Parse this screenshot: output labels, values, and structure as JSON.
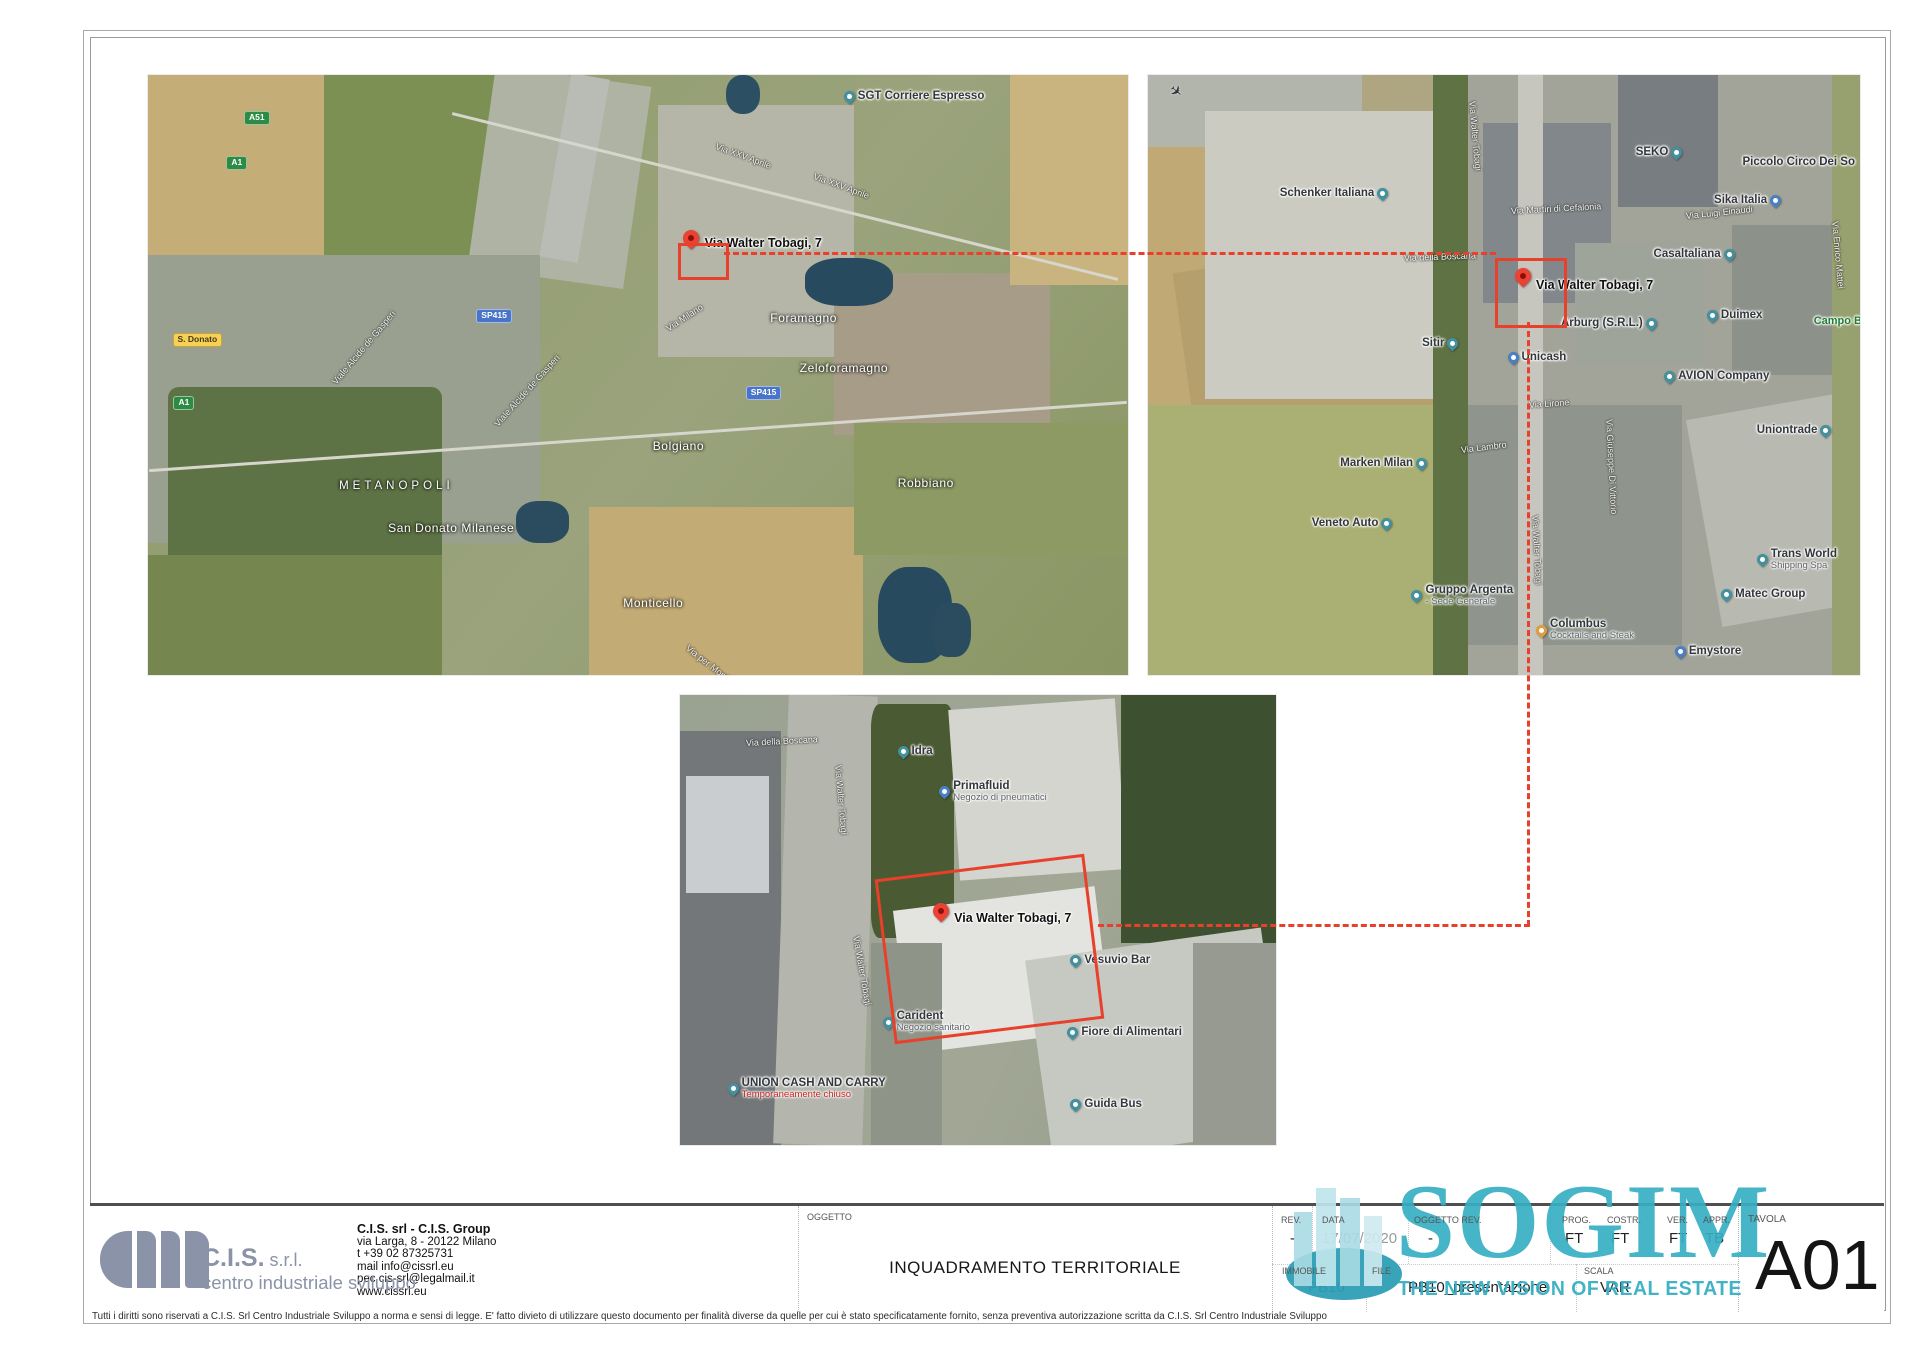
{
  "title_block": {
    "company": {
      "logo_name": "C.I.S.",
      "logo_suffix": " s.r.l.",
      "logo_sub": "centro industriale sviluppo",
      "name": "C.I.S. srl - C.I.S. Group",
      "address": "via Larga, 8 - 20122 Milano",
      "phone": "t +39 02 87325731",
      "mail": "mail   info@cissrl.eu",
      "pec": "pec   cis-srl@legalmail.it",
      "web": "www.cissrl.eu"
    },
    "oggetto": {
      "label": "OGGETTO",
      "value": "INQUADRAMENTO TERRITORIALE"
    },
    "fields": {
      "rev": {
        "label": "REV.",
        "value": "-"
      },
      "data": {
        "label": "DATA",
        "value": "17/07/2020"
      },
      "oggetto_rev": {
        "label": "OGGETTO REV.",
        "value": "-"
      },
      "prog": {
        "label": "PROG.",
        "value": "FT"
      },
      "costr": {
        "label": "COSTR.",
        "value": "FT"
      },
      "ver": {
        "label": "VER.",
        "value": "FT"
      },
      "appr": {
        "label": "APPR.",
        "value": "TB"
      },
      "immobile": {
        "label": "IMMOBILE",
        "value": "PB10"
      },
      "file": {
        "label": "FILE",
        "value": "PB10_presentazione"
      },
      "scala": {
        "label": "SCALA",
        "value": "VAR"
      },
      "tavola": {
        "label": "TAVOLA",
        "value": "A01"
      }
    },
    "sogim": {
      "name": "SOGIM",
      "tagline": "THE NEW VISION OF REAL ESTATE",
      "color": "#36afc3"
    }
  },
  "footer": {
    "text": "Tutti i diritti sono riservati a C.I.S. Srl Centro Industriale Sviluppo a norma e sensi di legge. E' fatto divieto di utilizzare questo documento per finalità diverse da quelle per cui è stato specificatamente fornito, senza preventiva autorizzazione scritta da C.I.S. Srl Centro Industriale Sviluppo",
    "site_annotation_color": "#e8402a"
  },
  "maps": {
    "map1": {
      "name": "wide-area satellite view",
      "labels": [
        {
          "t": "SGT Corriere Espresso",
          "x": 71,
          "y": 2.5,
          "k": "poi",
          "pin": "teal",
          "side": "l"
        },
        {
          "t": "Via XXV Aprile",
          "x": 58,
          "y": 11,
          "k": "road",
          "r": 20
        },
        {
          "t": "Via XXV Aprile",
          "x": 68,
          "y": 16,
          "k": "road",
          "r": 20
        },
        {
          "k": "marker",
          "x": 54.6,
          "y": 25.8
        },
        {
          "t": "Via Walter Tobagi, 7",
          "x": 56.8,
          "y": 26.8,
          "k": "addr"
        },
        {
          "t": "Foramagno",
          "x": 63.5,
          "y": 39.5,
          "k": "place"
        },
        {
          "t": "Zeloforamagno",
          "x": 66.5,
          "y": 47.8,
          "k": "place"
        },
        {
          "t": "Via Milano",
          "x": 53,
          "y": 41.5,
          "k": "road",
          "r": -33
        },
        {
          "t": "SP415",
          "x": 61,
          "y": 51.8,
          "k": "badge-blue"
        },
        {
          "t": "SP415",
          "x": 33.5,
          "y": 39,
          "k": "badge-blue"
        },
        {
          "t": "METANOPOLI",
          "x": 19.5,
          "y": 67.5,
          "k": "place-sp"
        },
        {
          "t": "S. Donato",
          "x": 2.5,
          "y": 43,
          "k": "badge-yellow"
        },
        {
          "t": "A1",
          "x": 2.6,
          "y": 53.5,
          "k": "badge-green"
        },
        {
          "t": "A51",
          "x": 9.8,
          "y": 6,
          "k": "badge-green"
        },
        {
          "t": "A1",
          "x": 8,
          "y": 13.5,
          "k": "badge-green"
        },
        {
          "t": "Viale Alcide de Gasperi",
          "x": 19,
          "y": 50.5,
          "k": "road",
          "r": -50
        },
        {
          "t": "Viale Alcide de Gasperi",
          "x": 35.5,
          "y": 57.5,
          "k": "road",
          "r": -48
        },
        {
          "t": "Bolgiano",
          "x": 51.5,
          "y": 60.8,
          "k": "place"
        },
        {
          "t": "San Donato Milanese",
          "x": 24.5,
          "y": 74.5,
          "k": "place"
        },
        {
          "t": "Robbiano",
          "x": 76.5,
          "y": 67,
          "k": "place"
        },
        {
          "t": "Monticello",
          "x": 48.5,
          "y": 87,
          "k": "place"
        },
        {
          "t": "Via per Monticello",
          "x": 55,
          "y": 94.5,
          "k": "road",
          "r": 38
        }
      ]
    },
    "map2": {
      "name": "neighbourhood satellite view",
      "labels": [
        {
          "k": "plane",
          "x": 3,
          "y": 1.5
        },
        {
          "t": "Schenker Italiana",
          "x": 18.5,
          "y": 18.6,
          "k": "poi",
          "pin": "teal",
          "side": "r"
        },
        {
          "t": "Via Walter Tobagi",
          "x": 45.5,
          "y": 3.5,
          "k": "road",
          "r": 85
        },
        {
          "t": "SEKO",
          "x": 68.5,
          "y": 11.8,
          "k": "poi",
          "pin": "teal",
          "side": "r"
        },
        {
          "t": "Piccolo Circo Dei So",
          "x": 83.5,
          "y": 13.5,
          "k": "poi"
        },
        {
          "t": "Sika Italia",
          "x": 79.5,
          "y": 19.8,
          "k": "poi",
          "pin": "blue",
          "side": "r"
        },
        {
          "t": "Via Luigi Einaudi",
          "x": 75.5,
          "y": 22.6,
          "k": "road",
          "r": -6
        },
        {
          "t": "Via Martiri di Cefalonia",
          "x": 51,
          "y": 21.8,
          "k": "road",
          "r": -3
        },
        {
          "t": "Casaltaliana",
          "x": 71,
          "y": 28.8,
          "k": "poi",
          "pin": "teal",
          "side": "r"
        },
        {
          "t": "Via della Boscana",
          "x": 36,
          "y": 29.6,
          "k": "road",
          "r": -2
        },
        {
          "k": "marker",
          "x": 51.5,
          "y": 32.2
        },
        {
          "t": "Via Walter Tobagi, 7",
          "x": 54.5,
          "y": 33.8,
          "k": "addr"
        },
        {
          "t": "Arburg (S.R.L.)",
          "x": 58,
          "y": 40.3,
          "k": "poi",
          "pin": "teal",
          "side": "r"
        },
        {
          "t": "Duimex",
          "x": 78.5,
          "y": 39,
          "k": "poi",
          "pin": "teal",
          "side": "l"
        },
        {
          "t": "Campo B",
          "x": 93.5,
          "y": 40,
          "k": "poi-green"
        },
        {
          "t": "Via Enrico Mattei",
          "x": 96.5,
          "y": 23.5,
          "k": "road",
          "r": 85
        },
        {
          "t": "Sitir",
          "x": 38.5,
          "y": 43.6,
          "k": "poi",
          "pin": "teal",
          "side": "r"
        },
        {
          "t": "Unicash",
          "x": 50.5,
          "y": 46,
          "k": "poi",
          "pin": "blue",
          "side": "l"
        },
        {
          "t": "AVION Company",
          "x": 72.5,
          "y": 49.2,
          "k": "poi",
          "pin": "teal",
          "side": "l"
        },
        {
          "t": "Via Lirone",
          "x": 53.5,
          "y": 54.2,
          "k": "road",
          "r": -4
        },
        {
          "t": "Via Giuseppe Di Vittorio",
          "x": 64.8,
          "y": 56.5,
          "k": "road",
          "r": 87
        },
        {
          "t": "Uniontrade",
          "x": 85.5,
          "y": 58.2,
          "k": "poi",
          "pin": "teal",
          "side": "r"
        },
        {
          "t": "Via Lambro",
          "x": 44,
          "y": 61.6,
          "k": "road",
          "r": -7
        },
        {
          "t": "Marken Milan",
          "x": 27,
          "y": 63.6,
          "k": "poi",
          "pin": "teal",
          "side": "r"
        },
        {
          "t": "Veneto Auto",
          "x": 23,
          "y": 73.6,
          "k": "poi",
          "pin": "teal",
          "side": "r"
        },
        {
          "t": "Via Walter Tobagi",
          "x": 54.4,
          "y": 72.5,
          "k": "road",
          "r": 87
        },
        {
          "t": "Gruppo Argenta",
          "sub": "- Sede Generale",
          "x": 37,
          "y": 84.8,
          "k": "poi",
          "pin": "teal",
          "side": "l"
        },
        {
          "t": "Columbus",
          "sub": "Cocktails and Steak",
          "x": 54.5,
          "y": 90.5,
          "k": "poi",
          "pin": "orange",
          "side": "l"
        },
        {
          "t": "Trans World",
          "sub": "Shipping Spa",
          "x": 85.5,
          "y": 78.8,
          "k": "poi",
          "pin": "teal",
          "side": "l"
        },
        {
          "t": "Matec Group",
          "x": 80.5,
          "y": 85.5,
          "k": "poi",
          "pin": "teal",
          "side": "l"
        },
        {
          "t": "Emystore",
          "x": 74,
          "y": 95,
          "k": "poi",
          "pin": "blue",
          "side": "l"
        }
      ]
    },
    "map3": {
      "name": "site satellite view",
      "labels": [
        {
          "t": "Via della Boscana",
          "x": 11,
          "y": 9.6,
          "k": "road",
          "r": -3
        },
        {
          "t": "Idra",
          "x": 36.5,
          "y": 11,
          "k": "poi",
          "pin": "teal",
          "side": "l"
        },
        {
          "t": "Primafluid",
          "sub": "Negozio di pneumatici",
          "x": 43.5,
          "y": 18.8,
          "k": "poi",
          "pin": "blue",
          "side": "l"
        },
        {
          "t": "Via Walter Tobagi",
          "x": 26.5,
          "y": 14.5,
          "k": "road",
          "r": 85
        },
        {
          "t": "Via Walter Tobagi",
          "x": 29.5,
          "y": 52.5,
          "k": "road",
          "r": 80
        },
        {
          "k": "marker",
          "x": 42.5,
          "y": 46.2
        },
        {
          "t": "Via Walter Tobagi, 7",
          "x": 46,
          "y": 48,
          "k": "addr"
        },
        {
          "t": "Vesuvio Bar",
          "x": 65.5,
          "y": 57.6,
          "k": "poi",
          "pin": "teal",
          "side": "l"
        },
        {
          "t": "Carident",
          "sub": "Negozio sanitario",
          "x": 34,
          "y": 70,
          "k": "poi",
          "pin": "teal",
          "side": "l"
        },
        {
          "t": "Fiore di Alimentari",
          "x": 65,
          "y": 73.6,
          "k": "poi",
          "pin": "teal",
          "side": "l"
        },
        {
          "t": "Guida Bus",
          "x": 65.5,
          "y": 89.6,
          "k": "poi",
          "pin": "teal",
          "side": "l"
        },
        {
          "t": "UNION CASH AND CARRY",
          "sub": "Temporaneamente chiuso",
          "subRed": true,
          "x": 8,
          "y": 84.8,
          "k": "poi",
          "pin": "teal",
          "side": "l"
        }
      ]
    }
  }
}
